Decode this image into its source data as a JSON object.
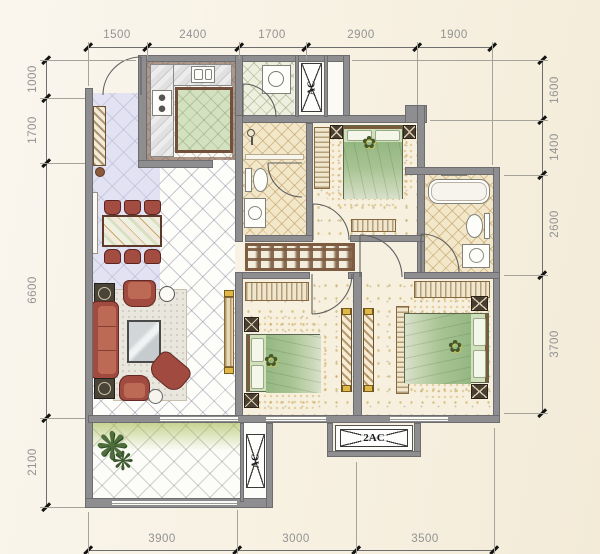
{
  "drawing": {
    "type": "apartment-floor-plan",
    "dims": {
      "top": [
        "1500",
        "2400",
        "1700",
        "2900",
        "1900"
      ],
      "left": [
        "1000",
        "1700",
        "6600",
        "2100"
      ],
      "right": [
        "1600",
        "1400",
        "2600",
        "3700"
      ],
      "bottom": [
        "3900",
        "3000",
        "3500"
      ]
    },
    "labels": {
      "ac_top": "AC",
      "ac_balcony": "AC",
      "ac_double": "2AC"
    },
    "icons": {
      "flower": "✿",
      "plant": "❋"
    },
    "colors": {
      "background": "#f8f2e4",
      "wall": "#8e8e91",
      "dim_text": "#929292",
      "bed_green": "#a9c698",
      "sofa_red": "#a04a40",
      "bath_tile": "#f3e7c9",
      "lavender_tile": "#ccccec",
      "balcony_green": "#a3b950",
      "gold_speckle": "#c99e46"
    }
  }
}
